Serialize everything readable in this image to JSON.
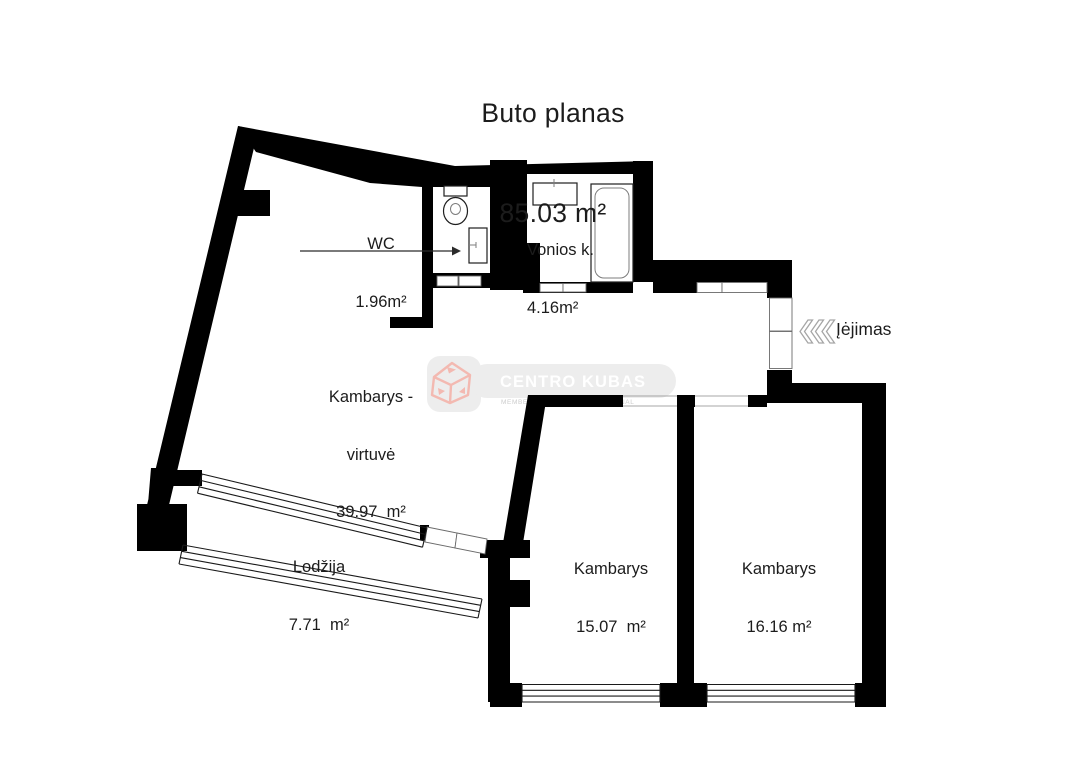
{
  "title": {
    "name": "Buto planas",
    "area": "85.03 m²"
  },
  "rooms": {
    "wc": {
      "name": "WC",
      "area": "1.96m²"
    },
    "bathroom": {
      "name": "Vonios k.",
      "area": "4.16m²"
    },
    "kitchen": {
      "line1": "Kambarys -",
      "line2": "virtuvė",
      "area": "39.97  m²"
    },
    "loggia": {
      "name": "Lodžija",
      "area": "7.71  m²"
    },
    "bedroom1": {
      "name": "Kambarys",
      "area": "15.07  m²"
    },
    "bedroom2": {
      "name": "Kambarys",
      "area": "16.16 m²"
    }
  },
  "entrance": {
    "label": "Įėjimas"
  },
  "watermark": {
    "brand": "CENTRO KUBAS",
    "subtext_left": "MEMBE",
    "subtext_right": "NAL"
  },
  "colors": {
    "wall": "#000000",
    "text": "#1c1c1c",
    "chevron": "#a6a6a6",
    "watermark_bg": "#ededed",
    "watermark_cube": "#f3b9b1",
    "watermark_text": "#ffffff",
    "watermark_subtext": "#cccccc"
  }
}
